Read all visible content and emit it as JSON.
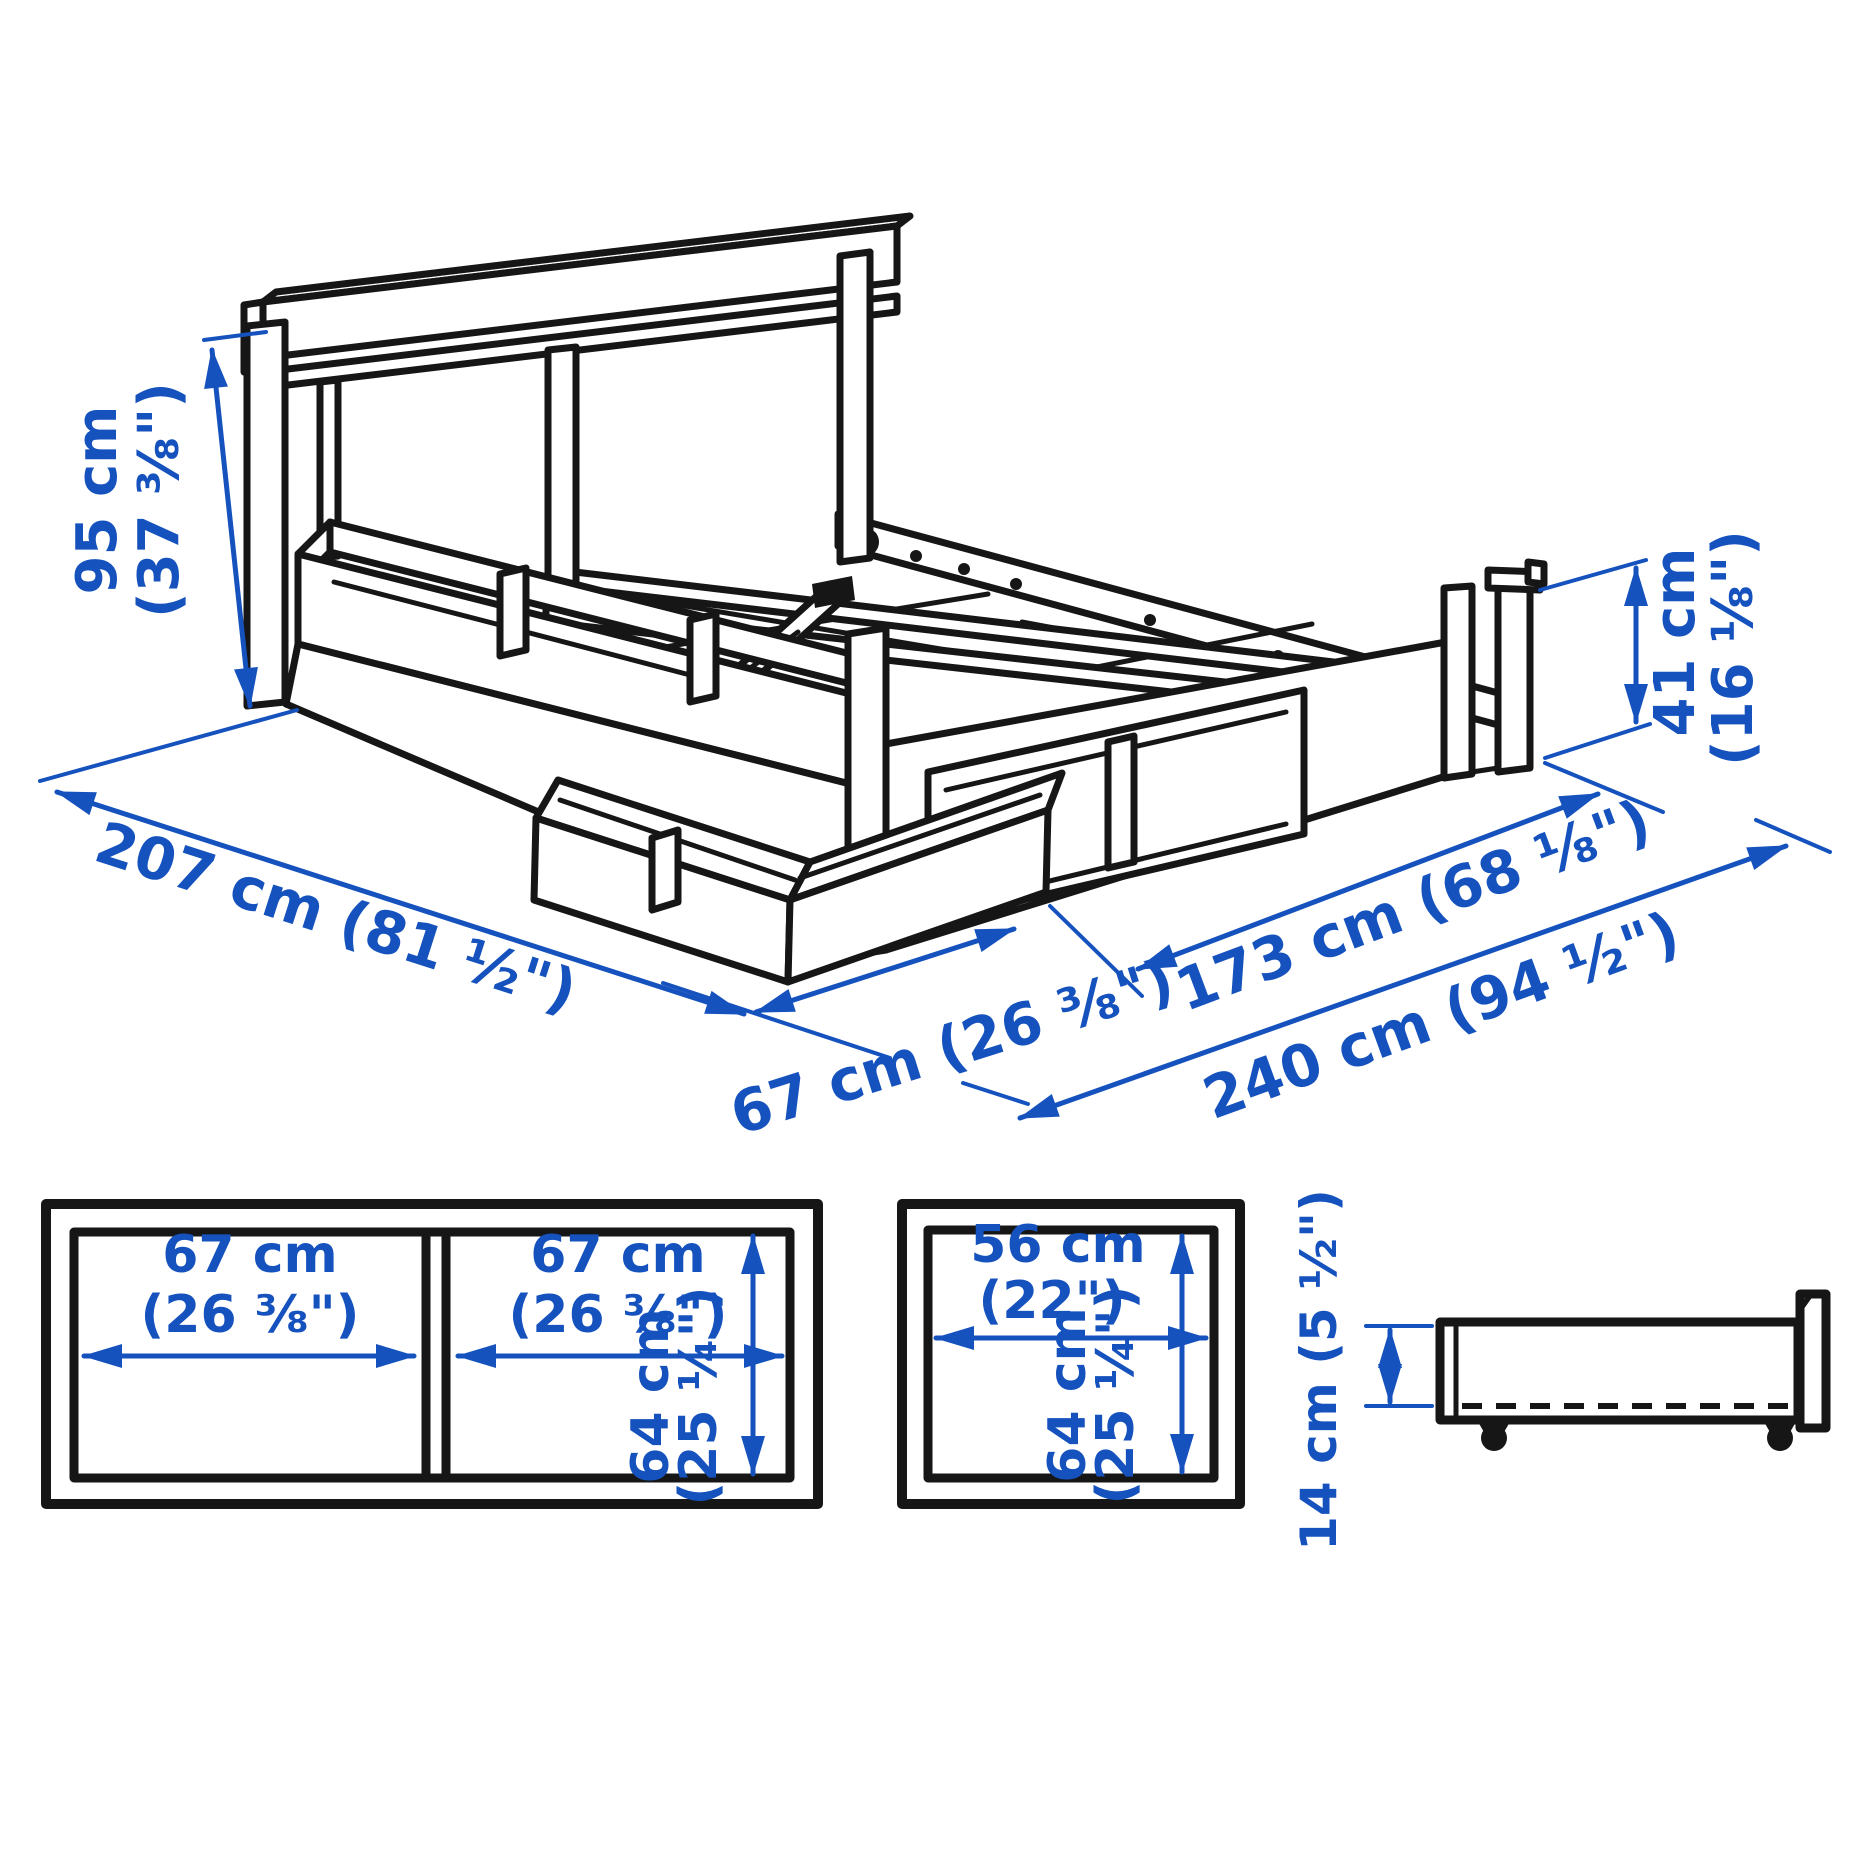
{
  "colors": {
    "dimension_blue": "#1552BE",
    "artwork_black": "#161616",
    "background": "#ffffff"
  },
  "main_view": {
    "headboard_height_cm": "95 cm",
    "headboard_height_in": "(37 ⅜\")",
    "length_label": "207 cm (81 ½\")",
    "footboard_height_cm": "41 cm",
    "footboard_height_in": "(16 ⅛\")",
    "drawer_extension_label": "67 cm (26 ⅜\")",
    "width_label": "173 cm (68 ⅛\")",
    "total_width_label": "240 cm (94 ½\")"
  },
  "double_box_view": {
    "left_width_cm": "67 cm",
    "left_width_in": "(26 ⅜\")",
    "right_width_cm": "67 cm",
    "right_width_in": "(26 ⅜\")",
    "depth_cm": "64 cm",
    "depth_in": "(25 ¼\")"
  },
  "single_box_view": {
    "width_cm": "56 cm",
    "width_in": "(22\")",
    "depth_cm": "64 cm",
    "depth_in": "(25 ¼\")"
  },
  "side_view": {
    "height_label": "14 cm (5 ½\")"
  }
}
